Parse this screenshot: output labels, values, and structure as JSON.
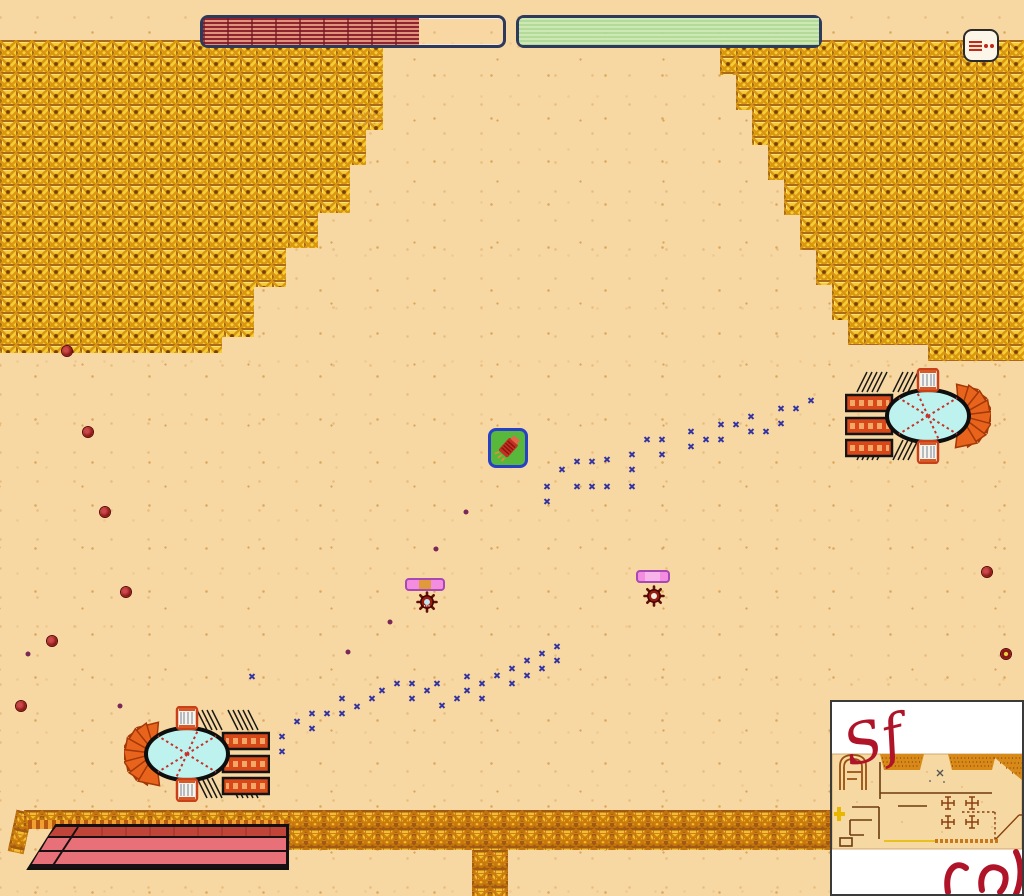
{
  "hud": {
    "left_bar": {
      "fill_percent": 72,
      "fill_color": "#8E2430",
      "border_color": "#2E3A5C"
    },
    "right_bar": {
      "fill_percent": 100,
      "fill_color": "#BAE2A0",
      "border_color": "#2E3A5C"
    },
    "item_slot": {
      "icon": "dynamite-item-icon",
      "accent_color": "#C02818"
    }
  },
  "palette": {
    "sand": "#F8D8A2",
    "tile_gold": "#F6CB34",
    "tile_grout": "#A96A1E",
    "pool_water": "#BDF2EE",
    "parasol_orange": "#E8641C",
    "towel_red": "#D84818",
    "awning_pink": "#E87078",
    "awning_red": "#C04438",
    "footprint": "#3535A2",
    "berry": "#8B1515",
    "graffiti": "#B01428"
  },
  "entities": {
    "pickup": {
      "x": 488,
      "y": 428,
      "icon": "red-extinguisher-icon",
      "bg": "#58B83C",
      "border": "#2840C8"
    },
    "pools": [
      {
        "name": "pool-top-right",
        "x": 845,
        "y": 368,
        "mirrored": false
      },
      {
        "name": "pool-bottom-left",
        "x": 124,
        "y": 706,
        "mirrored": true
      }
    ],
    "enemies": [
      {
        "x": 416,
        "y": 591,
        "center_color": "#BEE6F2",
        "bar": {
          "x": 405,
          "y": 578,
          "w": 36,
          "segment": "seg-orange"
        }
      },
      {
        "x": 643,
        "y": 585,
        "center_color": "#F2EFE4",
        "bar": {
          "x": 636,
          "y": 570,
          "w": 30,
          "segment": "seg-light"
        }
      }
    ]
  },
  "marks": {
    "footprint_color": "#3535A2",
    "footprints": [
      [
        547,
        486
      ],
      [
        547,
        501
      ],
      [
        562,
        469
      ],
      [
        577,
        461
      ],
      [
        592,
        461
      ],
      [
        607,
        459
      ],
      [
        577,
        486
      ],
      [
        592,
        486
      ],
      [
        607,
        486
      ],
      [
        632,
        454
      ],
      [
        632,
        469
      ],
      [
        632,
        486
      ],
      [
        647,
        439
      ],
      [
        662,
        439
      ],
      [
        662,
        454
      ],
      [
        691,
        431
      ],
      [
        691,
        446
      ],
      [
        706,
        439
      ],
      [
        721,
        424
      ],
      [
        721,
        439
      ],
      [
        736,
        424
      ],
      [
        751,
        416
      ],
      [
        751,
        431
      ],
      [
        766,
        431
      ],
      [
        781,
        408
      ],
      [
        781,
        423
      ],
      [
        796,
        408
      ],
      [
        811,
        400
      ],
      [
        252,
        676
      ],
      [
        282,
        736
      ],
      [
        282,
        751
      ],
      [
        297,
        721
      ],
      [
        312,
        713
      ],
      [
        312,
        728
      ],
      [
        327,
        713
      ],
      [
        342,
        698
      ],
      [
        342,
        713
      ],
      [
        357,
        706
      ],
      [
        372,
        698
      ],
      [
        382,
        690
      ],
      [
        397,
        683
      ],
      [
        412,
        683
      ],
      [
        412,
        698
      ],
      [
        427,
        690
      ],
      [
        437,
        683
      ],
      [
        442,
        705
      ],
      [
        457,
        698
      ],
      [
        467,
        676
      ],
      [
        467,
        690
      ],
      [
        482,
        683
      ],
      [
        482,
        698
      ],
      [
        497,
        675
      ],
      [
        512,
        668
      ],
      [
        512,
        683
      ],
      [
        527,
        660
      ],
      [
        527,
        675
      ],
      [
        542,
        653
      ],
      [
        542,
        668
      ],
      [
        557,
        646
      ],
      [
        557,
        660
      ]
    ],
    "berries": [
      [
        67,
        351
      ],
      [
        88,
        432
      ],
      [
        105,
        512
      ],
      [
        126,
        592
      ],
      [
        52,
        641
      ],
      [
        21,
        706
      ],
      [
        987,
        572
      ]
    ],
    "ring_berry": [
      1006,
      654
    ],
    "small_dots": [
      [
        28,
        654
      ],
      [
        120,
        706
      ],
      [
        390,
        622
      ],
      [
        436,
        549
      ],
      [
        466,
        512
      ],
      [
        348,
        652
      ]
    ]
  },
  "minimap": {
    "graffiti": "Sf"
  }
}
